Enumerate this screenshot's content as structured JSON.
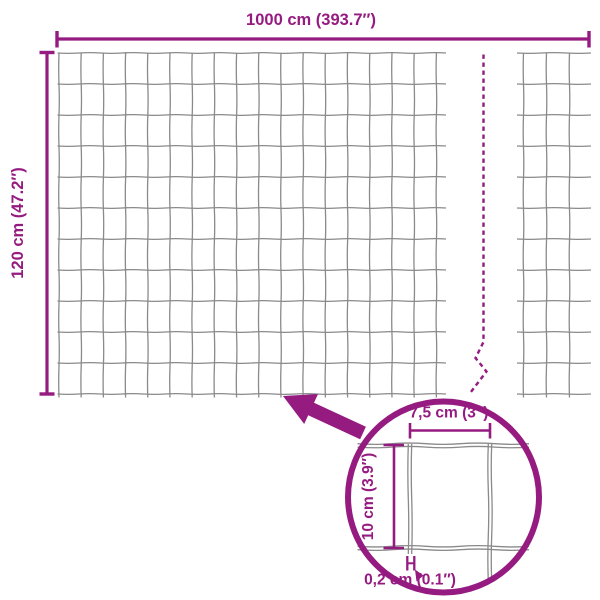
{
  "figure": {
    "type": "product-dimension-diagram",
    "subject": "welded wire mesh fence roll",
    "panel_visible_rows": 11,
    "panel_visible_cols": 17,
    "break_indicator": "dashed-line-mesh-continues"
  },
  "colors": {
    "accent": "#951b81",
    "wire": "#8a8a8a",
    "background": "#ffffff"
  },
  "labels": {
    "total_width": "1000 cm (393.7″)",
    "total_height": "120 cm (47.2″)",
    "cell_width": "7,5 cm (3″)",
    "cell_height": "10 cm (3.9″)",
    "wire_thickness": "0,2 cm (0.1″)"
  },
  "icons": {
    "zoom_arrow": "thick-arrow-pointing-up-left-to-mesh",
    "detail_circle": "magnified-detail-circle",
    "wire_gauge_marker": "h-shaped-thickness-marker",
    "thickness_pointer": "small-triangle-pointer"
  }
}
